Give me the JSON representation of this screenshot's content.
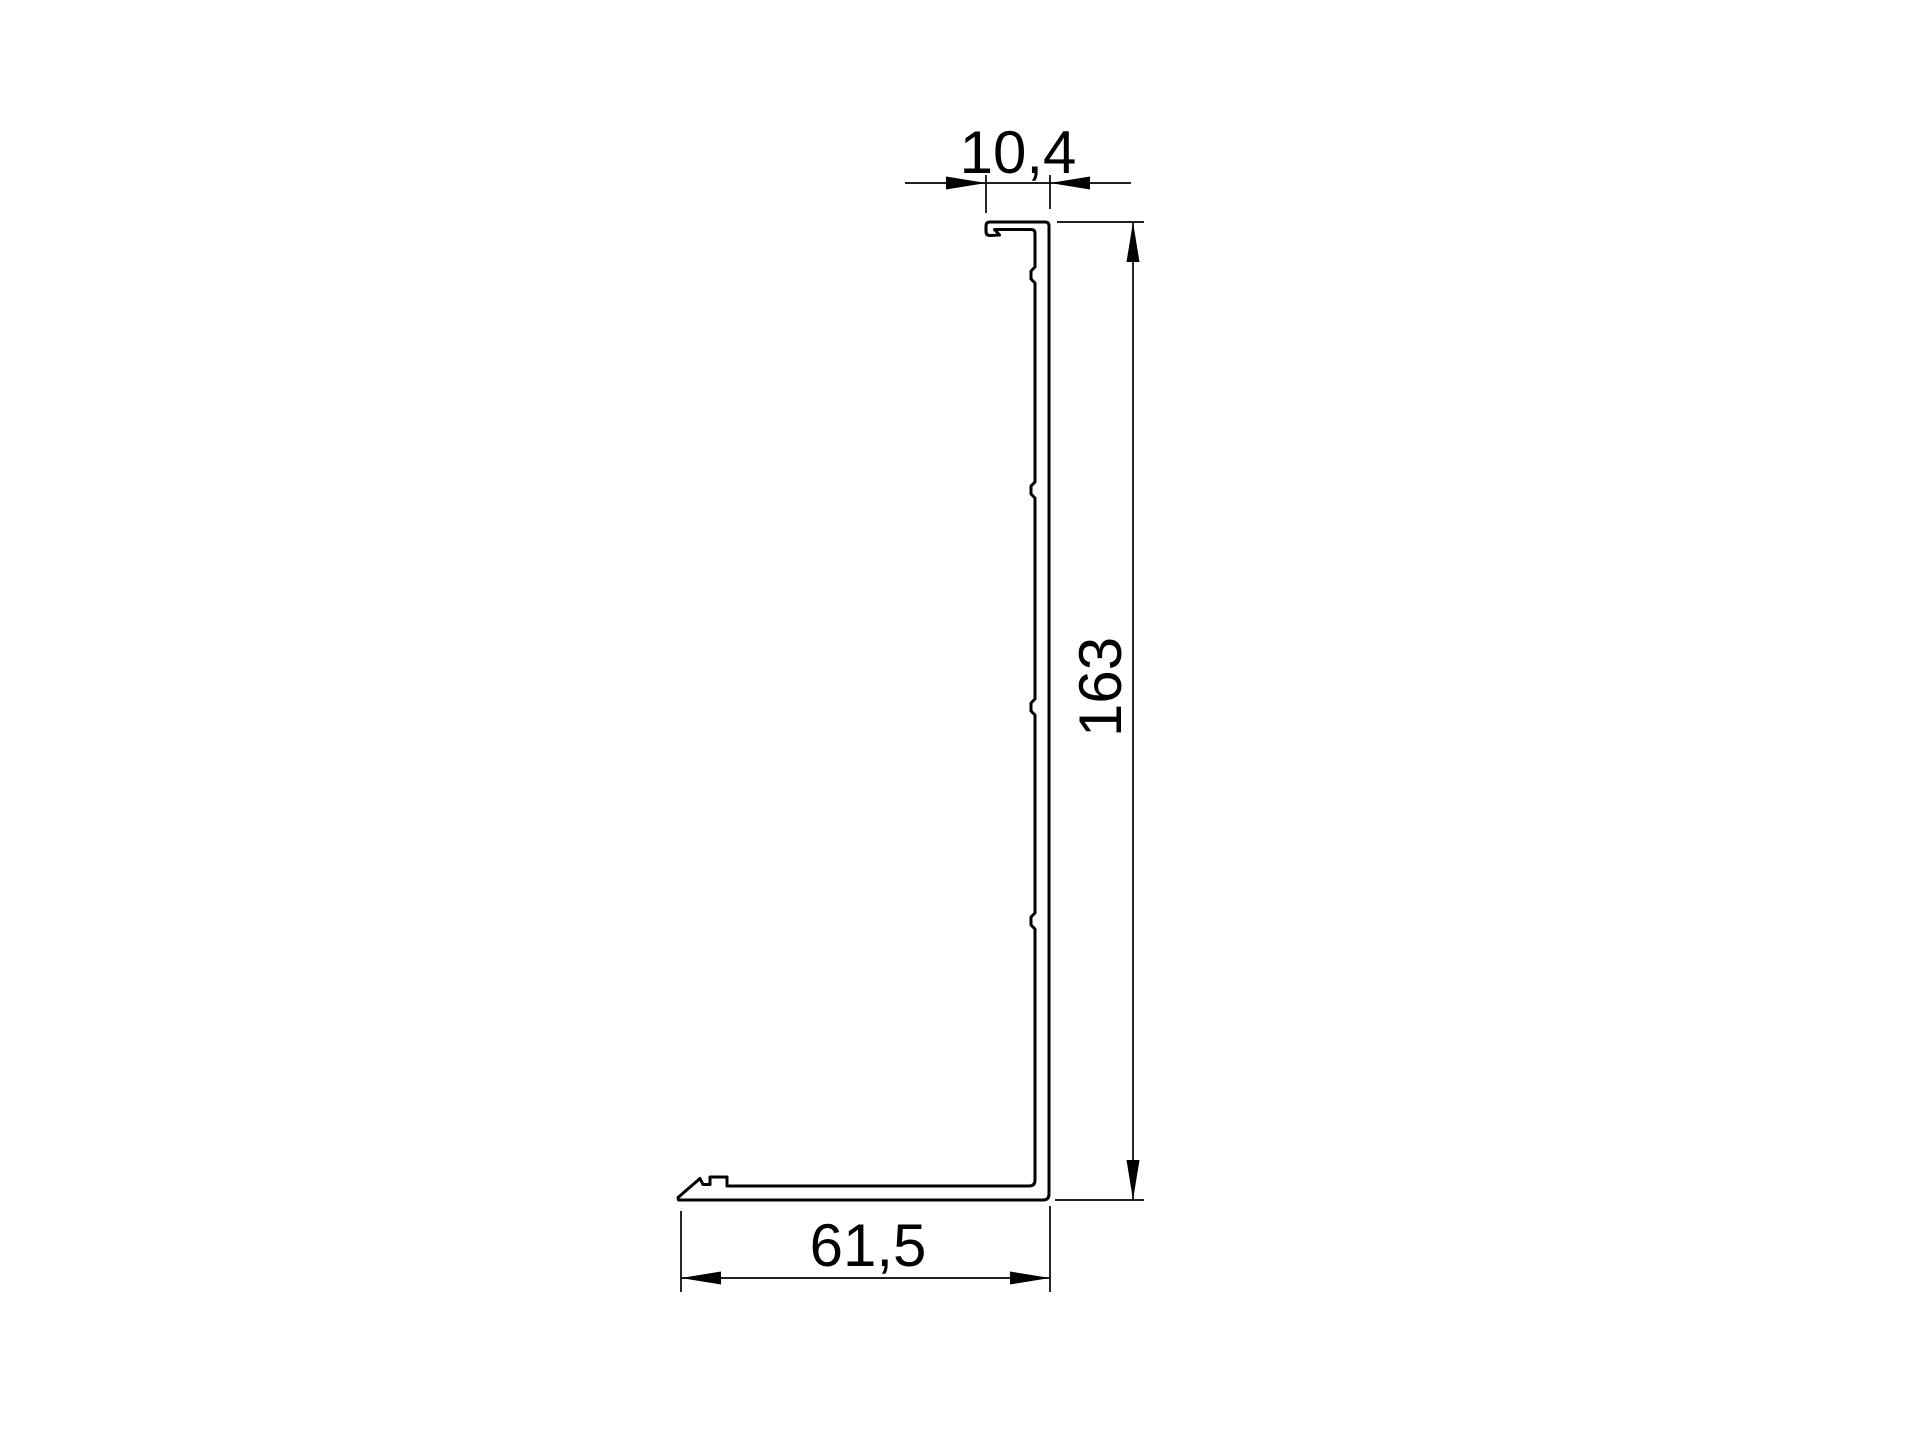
{
  "drawing": {
    "type": "technical-drawing-profile-cross-section",
    "background_color": "#ffffff",
    "line_color": "#000000"
  },
  "dimensions": {
    "top_width": {
      "label": "10,4"
    },
    "height": {
      "label": "163"
    },
    "bottom_width": {
      "label": "61,5"
    }
  }
}
